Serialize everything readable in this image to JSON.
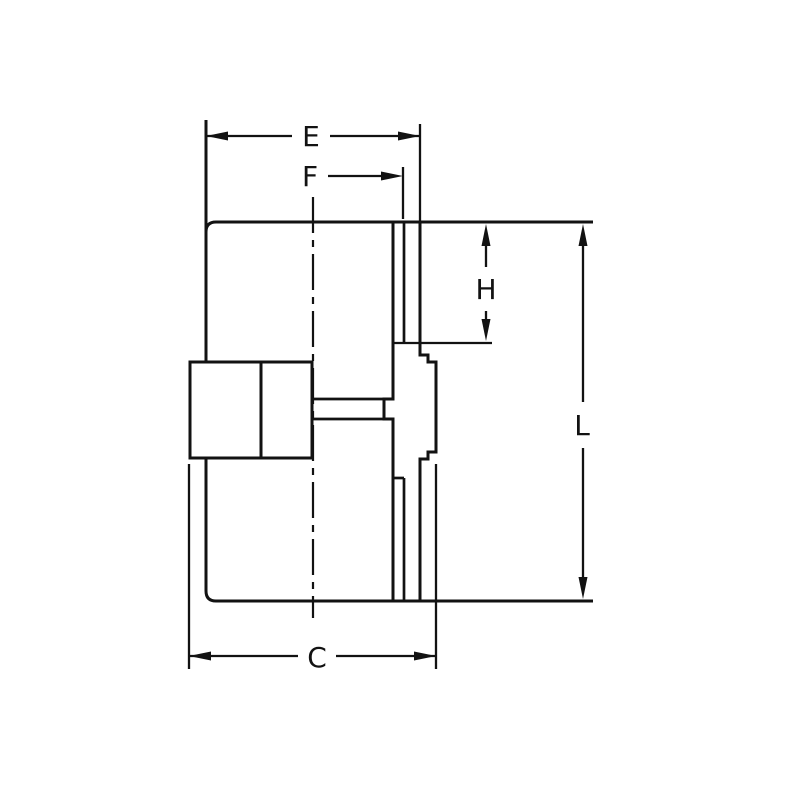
{
  "diagram": {
    "type": "engineering-section-drawing",
    "background_color": "#ffffff",
    "line_color": "#121212",
    "labels": {
      "e": "E",
      "f": "F",
      "h": "H",
      "l": "L",
      "c": "C"
    }
  }
}
